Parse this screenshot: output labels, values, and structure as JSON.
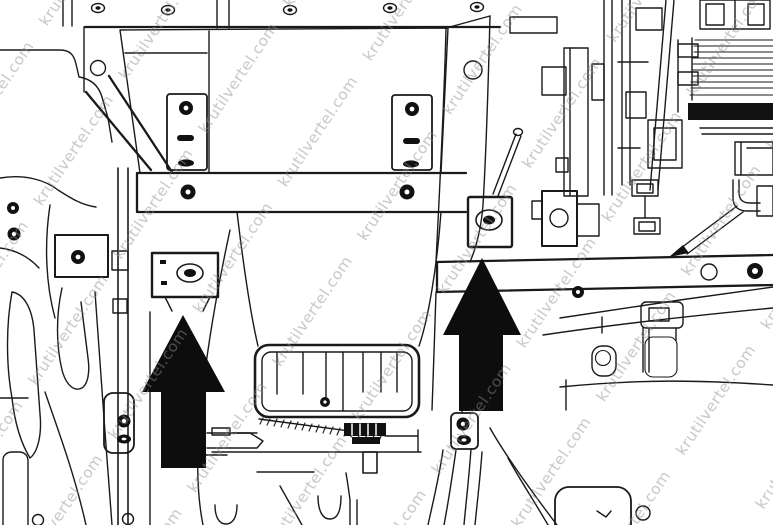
{
  "figure": {
    "type": "technical-line-illustration",
    "description": "Black-and-white service manual line drawing of a vehicle underbody chassis with brackets, bolts, skid plate and frame rails; two solid black arrows point upward at bracket mounting bolts",
    "annotation_arrows": [
      {
        "id": "left",
        "direction": "up",
        "tip_x": 183,
        "tip_y": 315,
        "head_left_x": 142,
        "head_right_x": 225,
        "head_base_y": 392,
        "shaft_left_x": 161,
        "shaft_right_x": 206,
        "base_y": 468
      },
      {
        "id": "right",
        "direction": "up",
        "tip_x": 482,
        "tip_y": 258,
        "head_left_x": 443,
        "head_right_x": 521,
        "head_base_y": 335,
        "shaft_left_x": 459,
        "shaft_right_x": 503,
        "base_y": 411
      }
    ]
  },
  "watermark": {
    "text": "krutilvertel.com",
    "color": "#8e8e8e",
    "opacity": "0.5"
  },
  "colors": {
    "background": "#ffffff",
    "line": "#1a1a1a",
    "arrow_fill": "#0d0d0d"
  }
}
